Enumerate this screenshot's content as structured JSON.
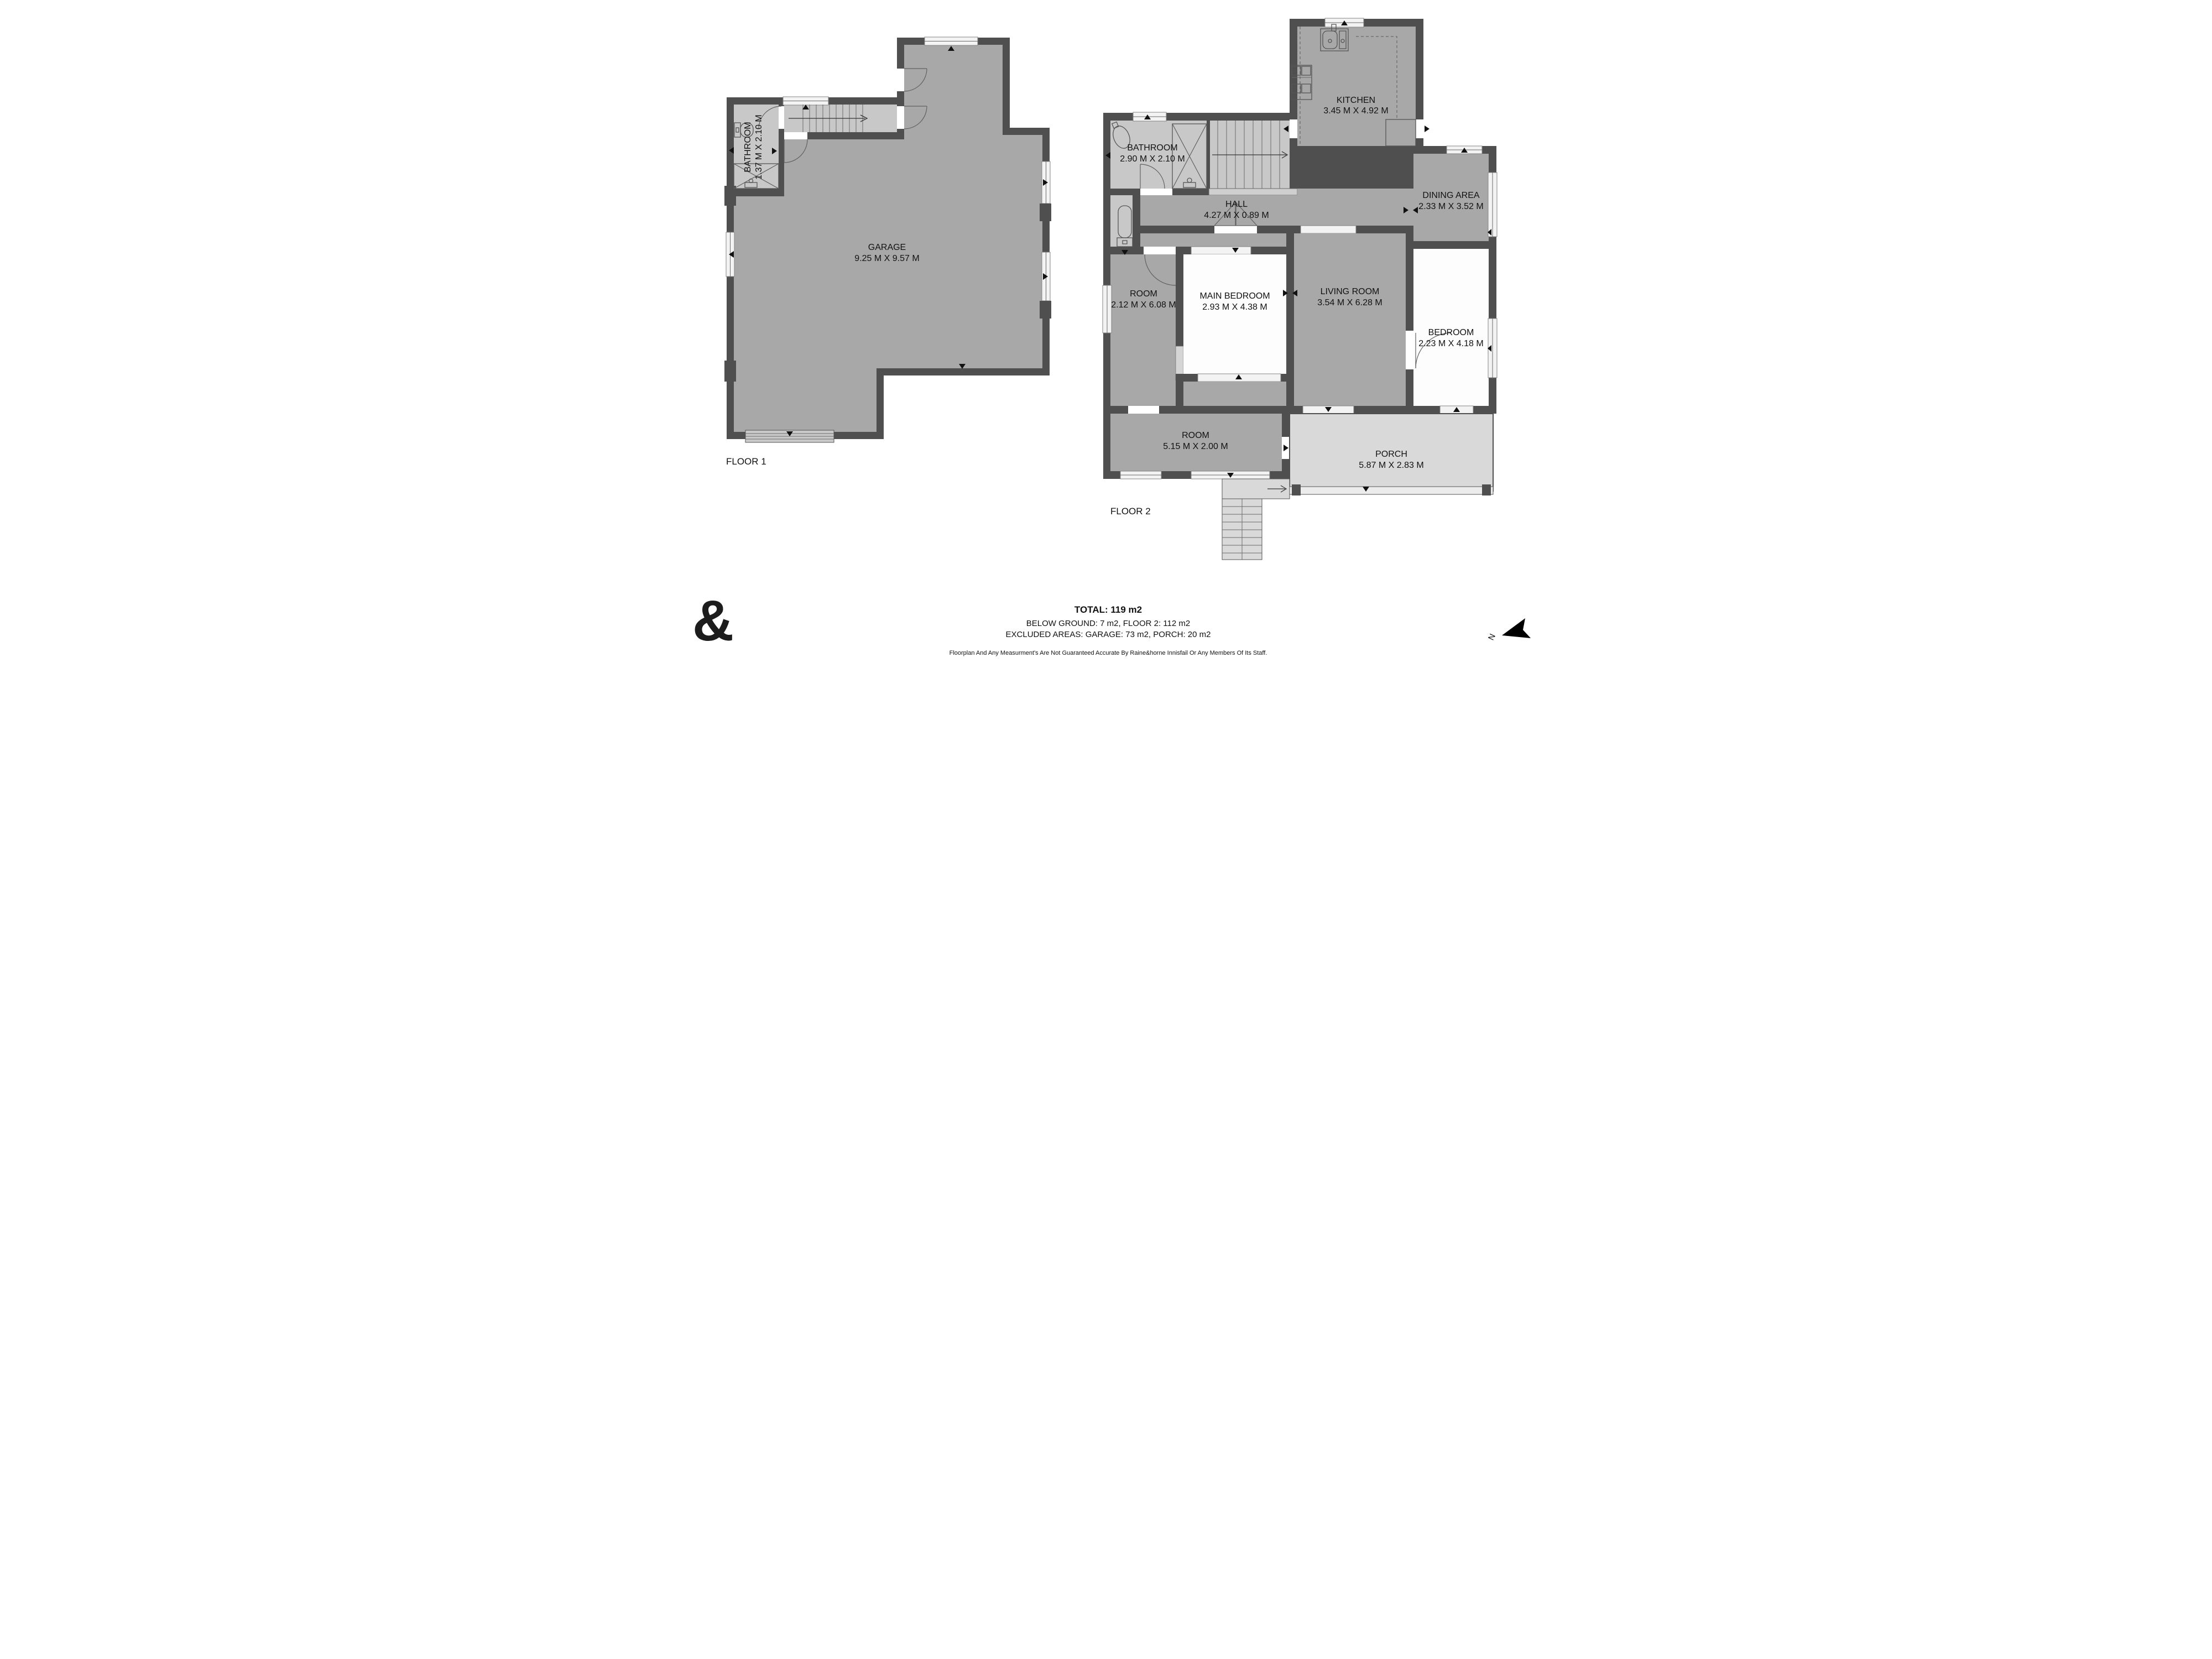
{
  "document_type": "floorplan",
  "floor1": {
    "label": "FLOOR 1",
    "rooms": {
      "garage": {
        "name": "GARAGE",
        "dims": "9.25 M X 9.57 M"
      },
      "bathroom": {
        "name": "BATHROOM",
        "dims": "1.37 M X 2.10 M"
      }
    }
  },
  "floor2": {
    "label": "FLOOR 2",
    "rooms": {
      "kitchen": {
        "name": "KITCHEN",
        "dims": "3.45 M X 4.92 M"
      },
      "bathroom": {
        "name": "BATHROOM",
        "dims": "2.90 M X 2.10 M"
      },
      "hall": {
        "name": "HALL",
        "dims": "4.27 M X 0.89 M"
      },
      "dining": {
        "name": "DINING AREA",
        "dims": "2.33 M X 3.52 M"
      },
      "room_left": {
        "name": "ROOM",
        "dims": "2.12 M X 6.08 M"
      },
      "main_bedroom": {
        "name": "MAIN BEDROOM",
        "dims": "2.93 M X 4.38 M"
      },
      "living": {
        "name": "LIVING ROOM",
        "dims": "3.54 M X 6.28 M"
      },
      "bedroom": {
        "name": "BEDROOM",
        "dims": "2.23 M X 4.18 M"
      },
      "room_bottom": {
        "name": "ROOM",
        "dims": "5.15 M X 2.00 M"
      },
      "porch": {
        "name": "PORCH",
        "dims": "5.87 M X 2.83 M"
      }
    }
  },
  "summary": {
    "total": "TOTAL: 119 m2",
    "areas": "BELOW GROUND: 7 m2, FLOOR 2: 112 m2",
    "excluded": "EXCLUDED AREAS: GARAGE: 73 m2, PORCH: 20 m2"
  },
  "disclaimer": "Floorplan And Any Measurment's Are Not Guaranteed Accurate By Raine&horne Innisfail Or Any Members Of Its Staff.",
  "branding": {
    "logo_glyph": "&"
  },
  "compass": {
    "label": "N"
  },
  "colors": {
    "wall": "#4f4f4f",
    "floor_gray": "#a8a8a8",
    "wet_room_gray": "#c8c8c8",
    "porch_gray": "#d9d9d9",
    "white_room": "#fdfdfd"
  }
}
